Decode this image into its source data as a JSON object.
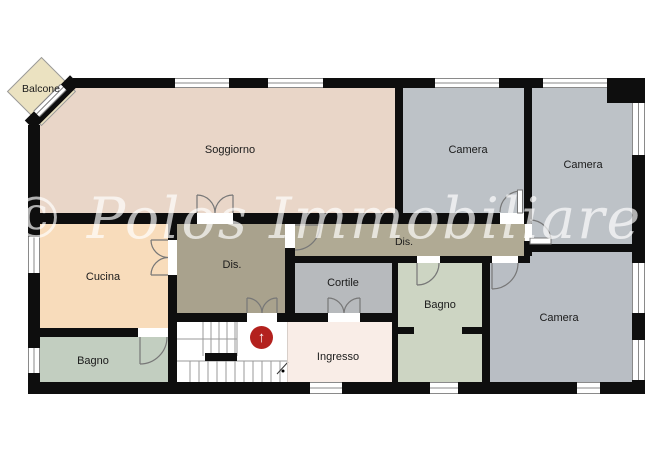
{
  "watermark": {
    "text": "© Polos Immobiliare"
  },
  "rooms": {
    "balcone": {
      "label": "Balcone",
      "color": "#ebe2c1"
    },
    "soggiorno": {
      "label": "Soggiorno",
      "color": "#e9d6c8"
    },
    "camera_top_left": {
      "label": "Camera",
      "color": "#bdc2c7"
    },
    "camera_top_right": {
      "label": "Camera",
      "color": "#bdc2c7"
    },
    "camera_bottom": {
      "label": "Camera",
      "color": "#b9bec4"
    },
    "cucina": {
      "label": "Cucina",
      "color": "#f8dcbb"
    },
    "bagno_left": {
      "label": "Bagno",
      "color": "#c2cec0"
    },
    "bagno_right": {
      "label": "Bagno",
      "color": "#cdd5c3"
    },
    "disimpegno_room": {
      "label": "Dis.",
      "color": "#a9a28d"
    },
    "disimpegno_corridor": {
      "label": "Dis.",
      "color": "#b0aa94"
    },
    "cortile": {
      "label": "Cortile",
      "color": "#b7babd"
    },
    "ingresso": {
      "label": "Ingresso",
      "color": "#f9ede7"
    },
    "stairwell": {
      "label": "",
      "color": "#ffffff"
    }
  },
  "stairs": {
    "arrow": "↑",
    "marker_color": "#b3211e"
  },
  "palette": {
    "walls": "#0e0e0e",
    "window_frame": "#8a8a8a",
    "door_lines": "#777777",
    "watermark_text": "rgba(255,255,255,0.68)"
  }
}
